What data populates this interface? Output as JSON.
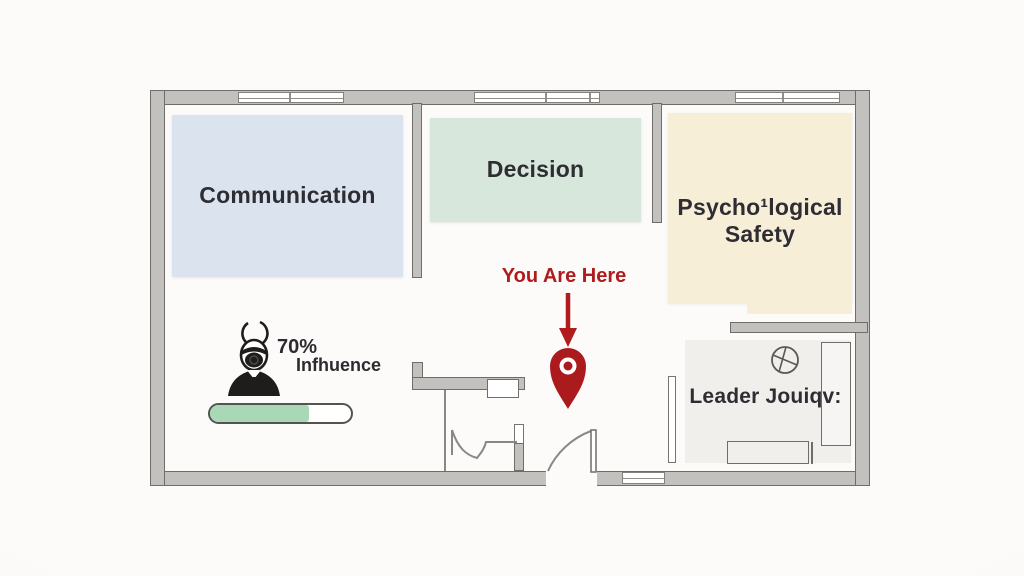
{
  "diagram": {
    "type": "office-floor-plan-infographic",
    "background": "#fcfbf9"
  },
  "rooms": {
    "communication": {
      "label": "Communication",
      "fill": "#dbe3ee"
    },
    "decision": {
      "label": "Decision",
      "fill": "#d7e7db"
    },
    "psychological_safety": {
      "line1": "Psycho¹logical",
      "line2": "Safety",
      "fill": "#f7eed8"
    },
    "leader_office": {
      "label": "Leader Jouiqv:",
      "fill": "#f0efec"
    }
  },
  "marker": {
    "label": "You Are Here",
    "color": "#b01b1e"
  },
  "influence": {
    "percent": "70%",
    "label": "Infhuence",
    "progress_percent": 70,
    "bar_color": "#a9d8b6"
  },
  "icons": [
    "person-icon",
    "map-pin-icon",
    "down-arrow-icon",
    "ceiling-fan-icon"
  ],
  "palette": {
    "wall_fill": "#c3c1be",
    "wall_outline": "#6f6c69",
    "text": "#2e2d33"
  }
}
